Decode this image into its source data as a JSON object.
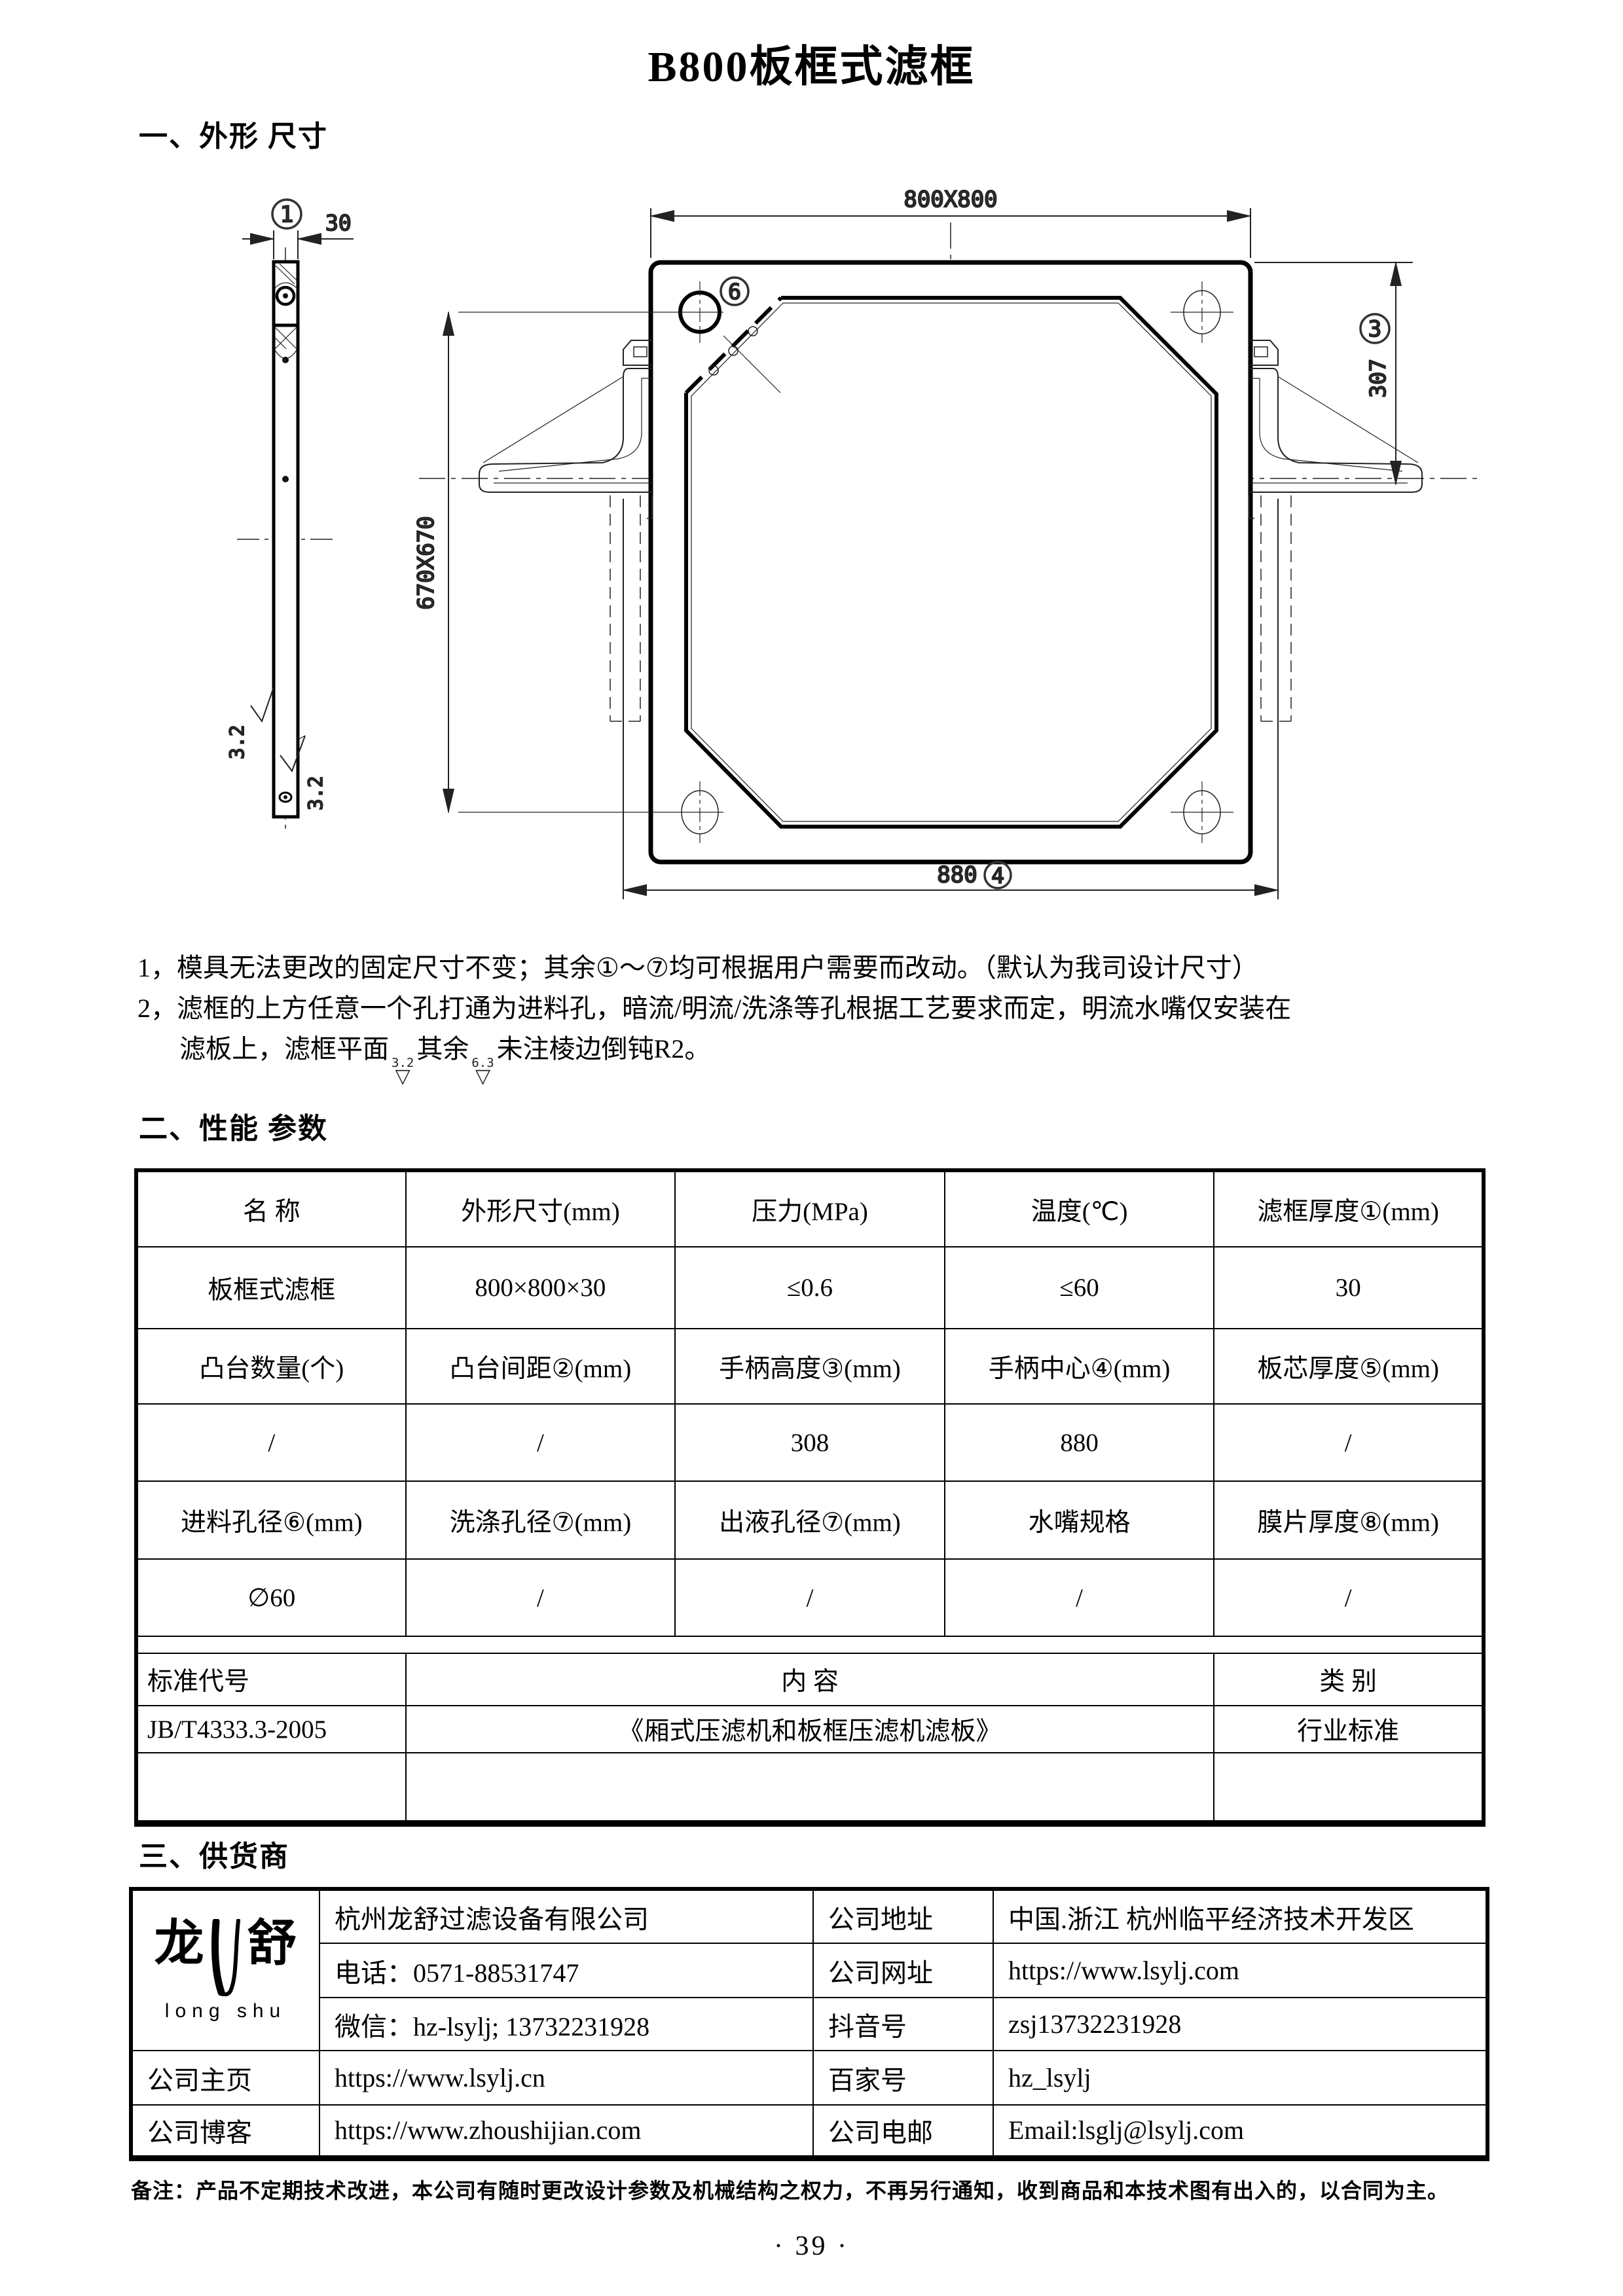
{
  "page": {
    "title": "B800板框式滤框",
    "page_number": "· 39 ·",
    "footer_note": "备注：产品不定期技术改进，本公司有随时更改设计参数及机械结构之权力，不再另行通知，收到商品和本技术图有出入的，以合同为主。"
  },
  "sections": {
    "s1": "一、外形 尺寸",
    "s2": "二、性能 参数",
    "s3": "三、供货商"
  },
  "notes": {
    "line1": "1，模具无法更改的固定尺寸不变；其余①～⑦均可根据用户需要而改动。（默认为我司设计尺寸）",
    "line2": "2，滤框的上方任意一个孔打通为进料孔，暗流/明流/洗涤等孔根据工艺要求而定，明流水嘴仅安装在",
    "line3_pre": "滤板上，滤框平面",
    "rough1": "3.2",
    "line3_mid": "其余",
    "rough2": "6.3",
    "line3_post": "未注棱边倒钝R2。",
    "glyph": "▽"
  },
  "drawing": {
    "dims": {
      "d800": "800X800",
      "d670": "670X670",
      "d307": "307",
      "d880": "880",
      "d30": "30",
      "rough_left": "3.2",
      "rough_right": "3.2"
    },
    "callouts": {
      "c1": "1",
      "c3": "3",
      "c4": "4",
      "c6": "6"
    }
  },
  "param_table": {
    "r1": [
      "名  称",
      "外形尺寸(mm)",
      "压力(MPa)",
      "温度(℃)",
      "滤框厚度①(mm)"
    ],
    "r2": [
      "板框式滤框",
      "800×800×30",
      "≤0.6",
      "≤60",
      "30"
    ],
    "r3": [
      "凸台数量(个)",
      "凸台间距②(mm)",
      "手柄高度③(mm)",
      "手柄中心④(mm)",
      "板芯厚度⑤(mm)"
    ],
    "r4": [
      "/",
      "/",
      "308",
      "880",
      "/"
    ],
    "r5": [
      "进料孔径⑥(mm)",
      "洗涤孔径⑦(mm)",
      "出液孔径⑦(mm)",
      "水嘴规格",
      "膜片厚度⑧(mm)"
    ],
    "r6": [
      "∅60",
      "/",
      "/",
      "/",
      "/"
    ],
    "r8": [
      "标准代号",
      "内      容",
      "类    别"
    ],
    "r9": [
      "JB/T4333.3-2005",
      "《厢式压滤机和板框压滤机滤板》",
      "行业标准"
    ]
  },
  "supplier": {
    "logo_zh_left": "龙",
    "logo_zh_right": "舒",
    "logo_en": "long shu",
    "name": "杭州龙舒过滤设备有限公司",
    "phone": "电话：0571-88531747",
    "wechat": "微信：hz-lsylj; 13732231928",
    "homepage_label": "公司主页",
    "homepage": "https://www.lsylj.cn",
    "blog_label": "公司博客",
    "blog": "https://www.zhoushijian.com",
    "addr_label": "公司地址",
    "addr": "中国.浙江 杭州临平经济技术开发区",
    "web_label": "公司网址",
    "web": "https://www.lsylj.com",
    "douyin_label": "抖音号",
    "douyin": "zsj13732231928",
    "baijia_label": "百家号",
    "baijia": "hz_lsylj",
    "email_label": "公司电邮",
    "email": "Email:lsglj@lsylj.com"
  }
}
